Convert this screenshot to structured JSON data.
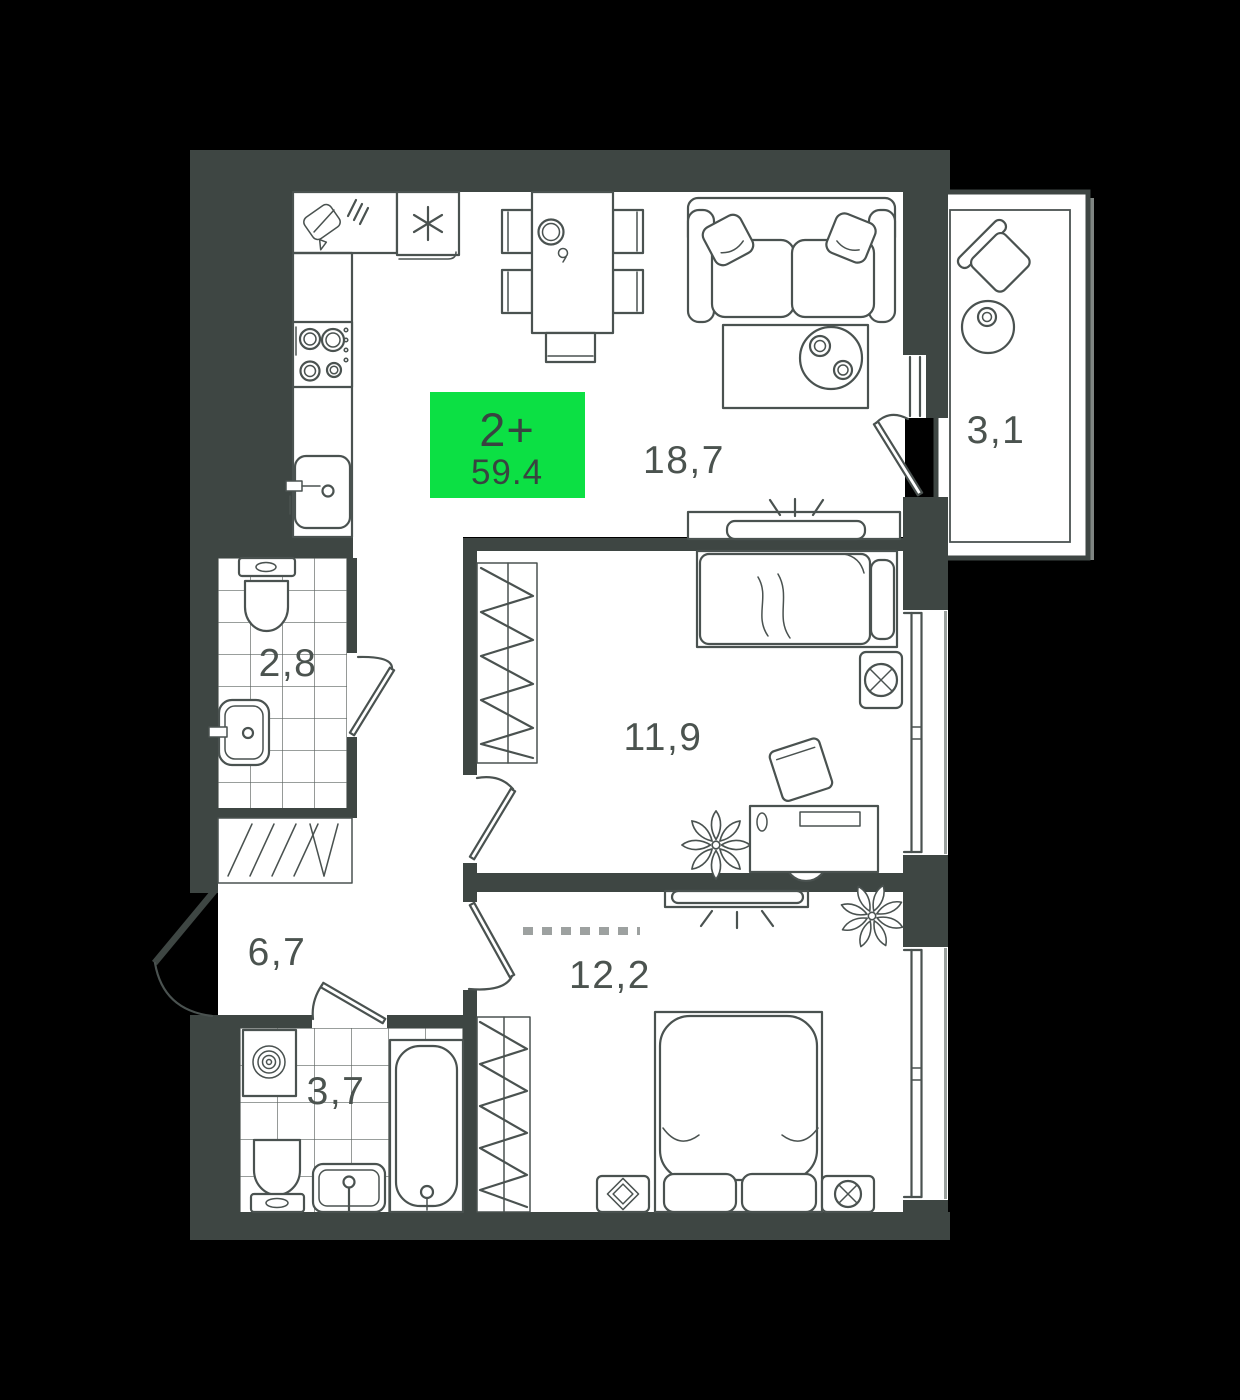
{
  "plan": {
    "badge": {
      "rooms_label": "2+",
      "area_value": "59.4"
    },
    "rooms": [
      {
        "name": "kitchen-living-room",
        "area": "18,7"
      },
      {
        "name": "balcony",
        "area": "3,1"
      },
      {
        "name": "bathroom-small",
        "area": "2,8"
      },
      {
        "name": "bedroom-1",
        "area": "11,9"
      },
      {
        "name": "hallway",
        "area": "6,7"
      },
      {
        "name": "bedroom-2",
        "area": "12,2"
      },
      {
        "name": "bathroom-big",
        "area": "3,7"
      }
    ],
    "colors": {
      "bg": "#000000",
      "wall": "#3e4643",
      "line": "#4a5250",
      "floor": "#ffffff",
      "badge": "#0ce044",
      "badge_text": "#384440",
      "label": "#4b534f",
      "tile": "#5c6360"
    }
  }
}
